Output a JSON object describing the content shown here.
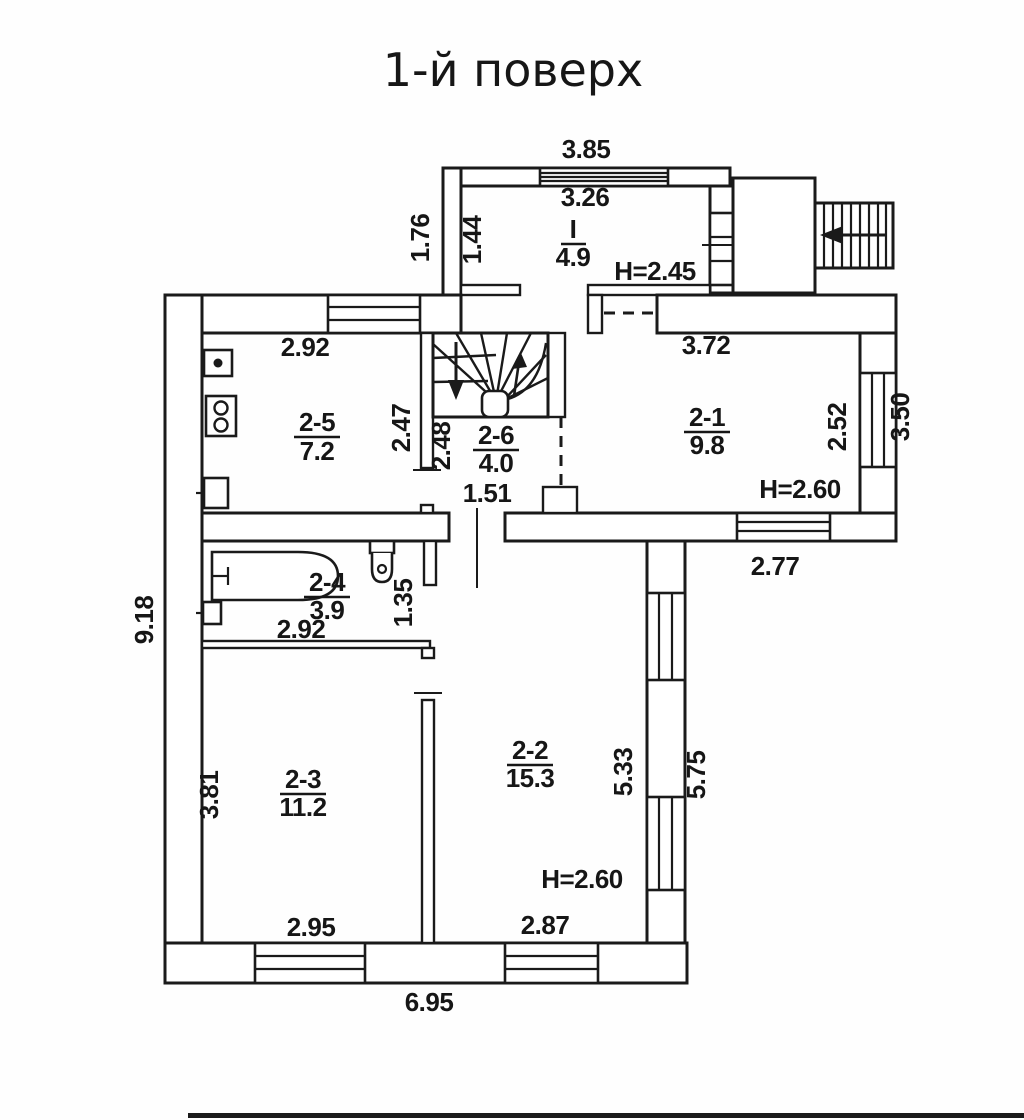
{
  "title": "1-й поверх",
  "plan": {
    "rooms": [
      {
        "number": "I",
        "area": "4.9",
        "height": "H=2.45"
      },
      {
        "number": "2-1",
        "area": "9.8",
        "height": "H=2.60"
      },
      {
        "number": "2-2",
        "area": "15.3",
        "height": "H=2.60"
      },
      {
        "number": "2-3",
        "area": "11.2"
      },
      {
        "number": "2-4",
        "area": "3.9"
      },
      {
        "number": "2-5",
        "area": "7.2"
      },
      {
        "number": "2-6",
        "area": "4.0"
      }
    ],
    "dims": {
      "top_outer": "3.85",
      "top_inner": "3.26",
      "entry_depth_outer": "1.76",
      "entry_depth_inner": "1.44",
      "kitchen_width": "2.92",
      "kitchen_depth": "2.47",
      "stair_depth": "2.48",
      "hall_width": "1.51",
      "r21_width": "3.72",
      "r21_window": "2.52",
      "right_side_outer": "3.50",
      "r21_bottom": "2.77",
      "bath_width": "2.92",
      "bath_side": "1.35",
      "r23_depth": "3.81",
      "r23_width": "2.95",
      "r22_depth_inner": "5.33",
      "r22_depth_outer": "5.75",
      "r22_width": "2.87",
      "bottom_outer": "6.95",
      "left_outer": "9.18"
    }
  }
}
